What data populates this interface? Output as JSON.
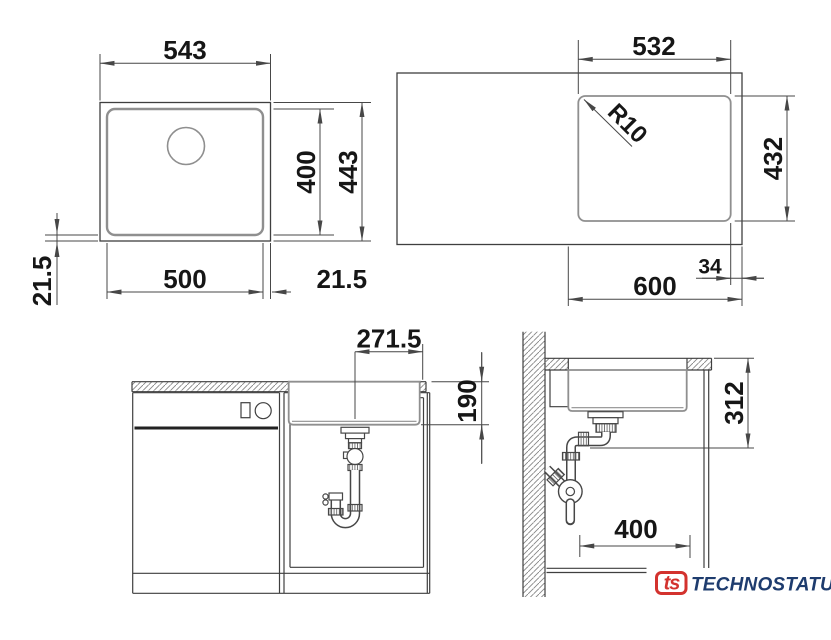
{
  "drawing": {
    "colors": {
      "line": "#3f3f3f",
      "dim": "#474747",
      "text": "#161616",
      "basin": "#8f8f8f",
      "hatch": "#858585",
      "knurl": "#6a6a6a"
    },
    "views": {
      "sink_top": {
        "outer_width": "543",
        "inner_height": "400",
        "outer_height": "443",
        "inner_width": "500",
        "rim_left": "21.5",
        "rim_right": "21.5"
      },
      "counter_top": {
        "cutout_width": "532",
        "corner_radius": "R10",
        "cutout_height": "432",
        "edge_offset": "34",
        "cabinet_width": "600"
      },
      "front": {
        "drain_offset": "271.5",
        "bowl_depth": "190"
      },
      "side": {
        "outlet_height": "312",
        "outlet_distance": "400"
      }
    },
    "logo": {
      "mark": "ts",
      "brand": "TECHNOSTATUS",
      "red": "#d3322e",
      "navy": "#1e3c6e"
    }
  }
}
